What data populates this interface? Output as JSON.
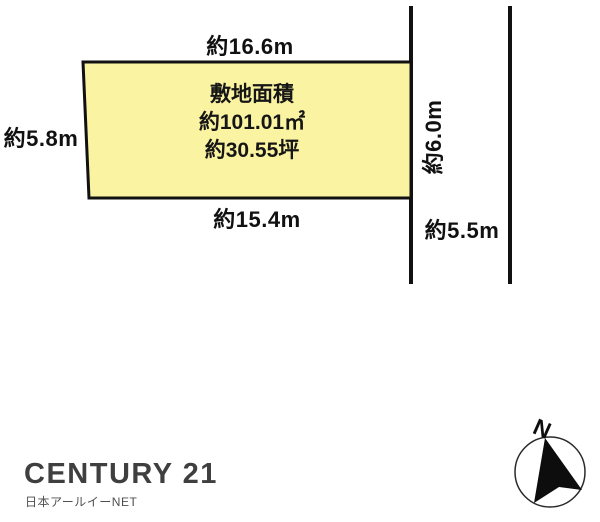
{
  "diagram": {
    "site": {
      "label": "敷地面積",
      "area_sqm": "約101.01㎡",
      "area_tsubo": "約30.55坪"
    },
    "dimensions": {
      "top": "約16.6m",
      "left": "約5.8m",
      "bottom": "約15.4m",
      "right": "約6.0m",
      "road": "約5.5m"
    },
    "compass": {
      "north_label": "N"
    },
    "colors": {
      "plot_fill": "#faf3a2",
      "plot_stroke": "#111111",
      "road_line": "#111111",
      "logo_text": "#3f3f3f"
    }
  },
  "branding": {
    "logo_text": "CENTURY 21",
    "subtext": "日本アールイーNET"
  }
}
